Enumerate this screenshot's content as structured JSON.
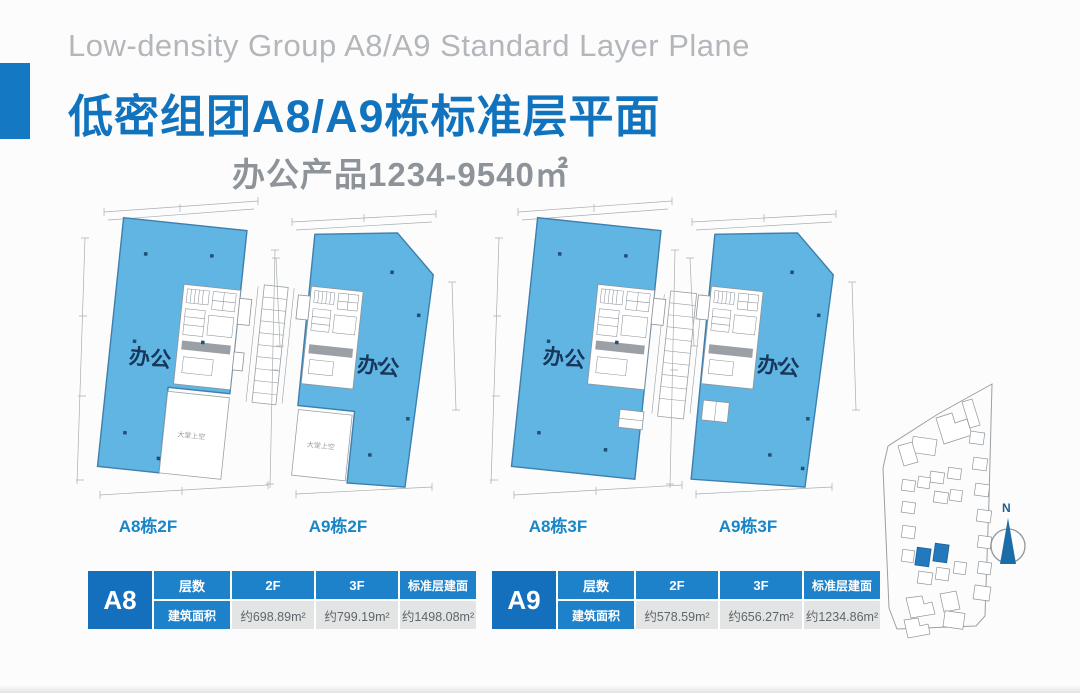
{
  "slide": {
    "title_en": "Low-density Group A8/A9 Standard Layer Plane",
    "title_zh": "低密组团A8/A9栋标准层平面",
    "subtitle": "办公产品1234-9540㎡"
  },
  "plans": [
    {
      "label": "A8栋2F",
      "zone": "办公",
      "lobby": "大堂上空"
    },
    {
      "label": "A9栋2F",
      "zone": "办公",
      "lobby": "大堂上空"
    },
    {
      "label": "A8栋3F",
      "zone": "办公"
    },
    {
      "label": "A9栋3F",
      "zone": "办公"
    }
  ],
  "tables": [
    {
      "building": "A8",
      "floors_label": "层数",
      "area_label": "建筑面积",
      "col_2f": "2F",
      "col_3f": "3F",
      "col_std": "标准层建面",
      "area_2f": "约698.89m²",
      "area_3f": "约799.19m²",
      "area_std": "约1498.08m²"
    },
    {
      "building": "A9",
      "floors_label": "层数",
      "area_label": "建筑面积",
      "col_2f": "2F",
      "col_3f": "3F",
      "col_std": "标准层建面",
      "area_2f": "约578.59m²",
      "area_3f": "约656.27m²",
      "area_std": "约1234.86m²"
    }
  ],
  "sitemap": {
    "compass": "N"
  },
  "colors": {
    "accent_blue": "#1478c2",
    "title_blue": "#1173bd",
    "plan_fill": "#61b5e2",
    "table_header_blue": "#1e82ca",
    "table_building_blue": "#1470bd",
    "table_data_bg": "#e3e5e5",
    "title_en_gray": "#b3b7bb",
    "subtitle_gray": "#8d9398",
    "highlight_building": "#2478bc"
  }
}
